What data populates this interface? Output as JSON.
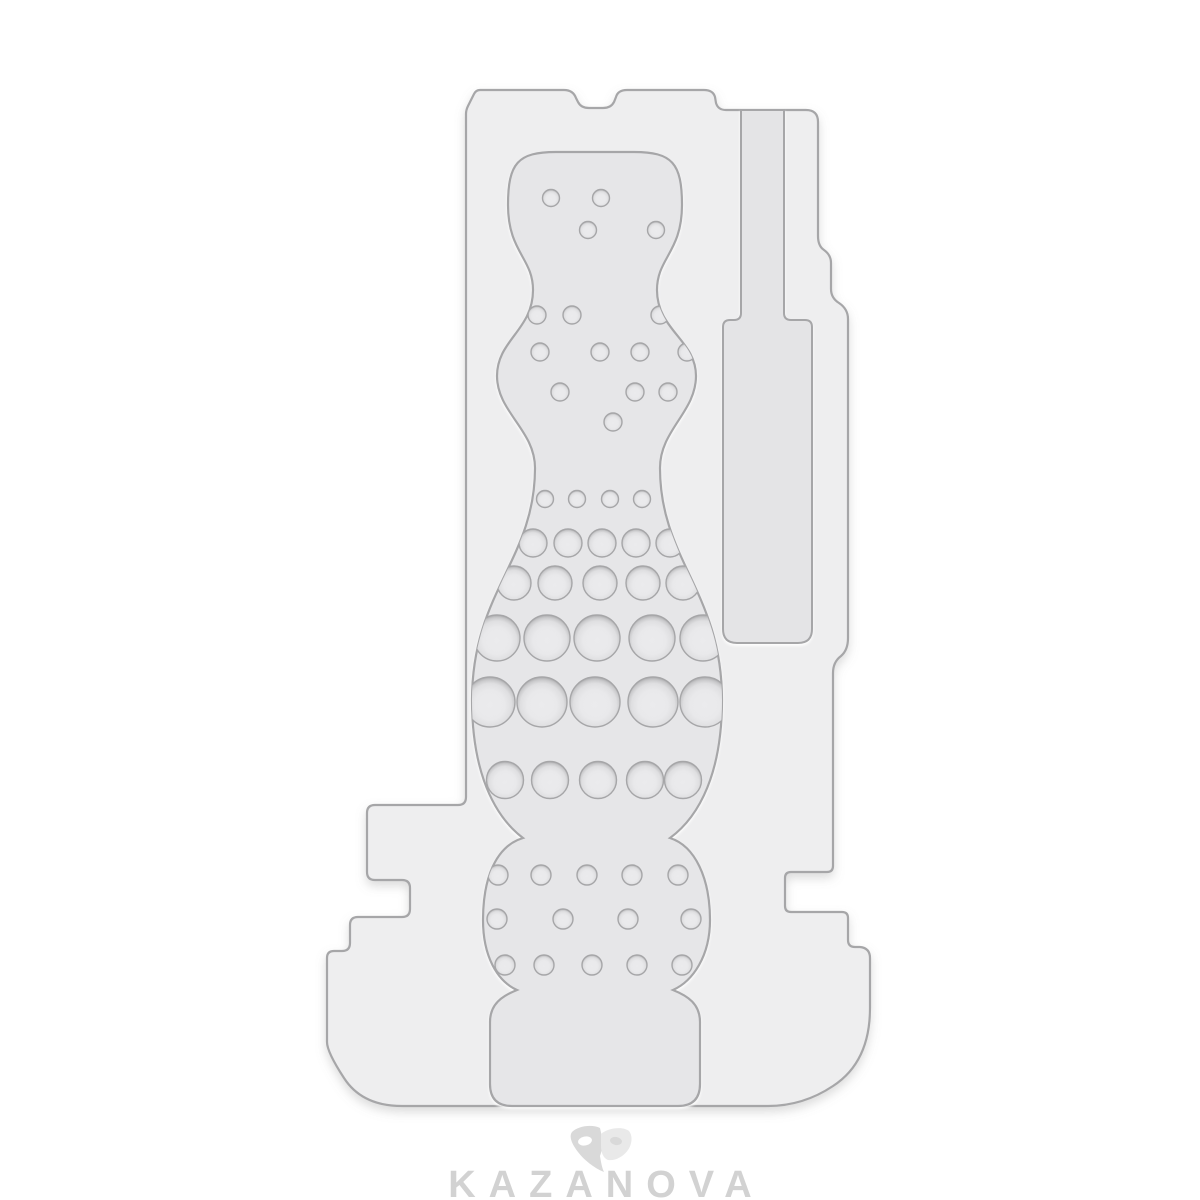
{
  "page": {
    "background_color": "#ffffff",
    "content_type": "product-photo"
  },
  "product_figure": {
    "name": "textured-sleeve-insert-plate",
    "plate_color": "#eeeeef",
    "groove_color": "#e4e4e6",
    "cavity_color": "#e6e6e8",
    "edge_color": "#a6a6a8",
    "dot_center_color": "#ebebed",
    "dot_rim_color": "#b4b4b6",
    "dot_rows": [
      {
        "y": 198,
        "d": 17,
        "xs": [
          551,
          601
        ]
      },
      {
        "y": 230,
        "d": 17,
        "xs": [
          588,
          656
        ]
      },
      {
        "y": 315,
        "d": 18,
        "xs": [
          537,
          572,
          660
        ]
      },
      {
        "y": 352,
        "d": 18,
        "xs": [
          540,
          600,
          640,
          687
        ]
      },
      {
        "y": 392,
        "d": 18,
        "xs": [
          560,
          635,
          668
        ]
      },
      {
        "y": 422,
        "d": 18,
        "xs": [
          613
        ]
      },
      {
        "y": 499,
        "d": 17,
        "xs": [
          545,
          577,
          610,
          642
        ]
      },
      {
        "y": 543,
        "d": 28,
        "xs": [
          533,
          568,
          602,
          636,
          670
        ]
      },
      {
        "y": 583,
        "d": 34,
        "xs": [
          514,
          555,
          600,
          643,
          683
        ]
      },
      {
        "y": 638,
        "d": 46,
        "xs": [
          497,
          547,
          597,
          652,
          703
        ]
      },
      {
        "y": 702,
        "d": 50,
        "xs": [
          490,
          542,
          595,
          653,
          705
        ]
      },
      {
        "y": 780,
        "d": 37,
        "xs": [
          505,
          550,
          598,
          645,
          683
        ]
      },
      {
        "y": 875,
        "d": 20,
        "xs": [
          498,
          541,
          587,
          632,
          678
        ]
      },
      {
        "y": 919,
        "d": 20,
        "xs": [
          497,
          563,
          628,
          691
        ]
      },
      {
        "y": 965,
        "d": 20,
        "xs": [
          505,
          544,
          592,
          637,
          682
        ]
      }
    ]
  },
  "watermark": {
    "brand": "KAZANOVA",
    "icon": "theater-masks-icon",
    "text_color": "#d2d2d2",
    "icon_primary_color": "#d9d9d9",
    "icon_secondary_color": "#e9e9e9"
  }
}
